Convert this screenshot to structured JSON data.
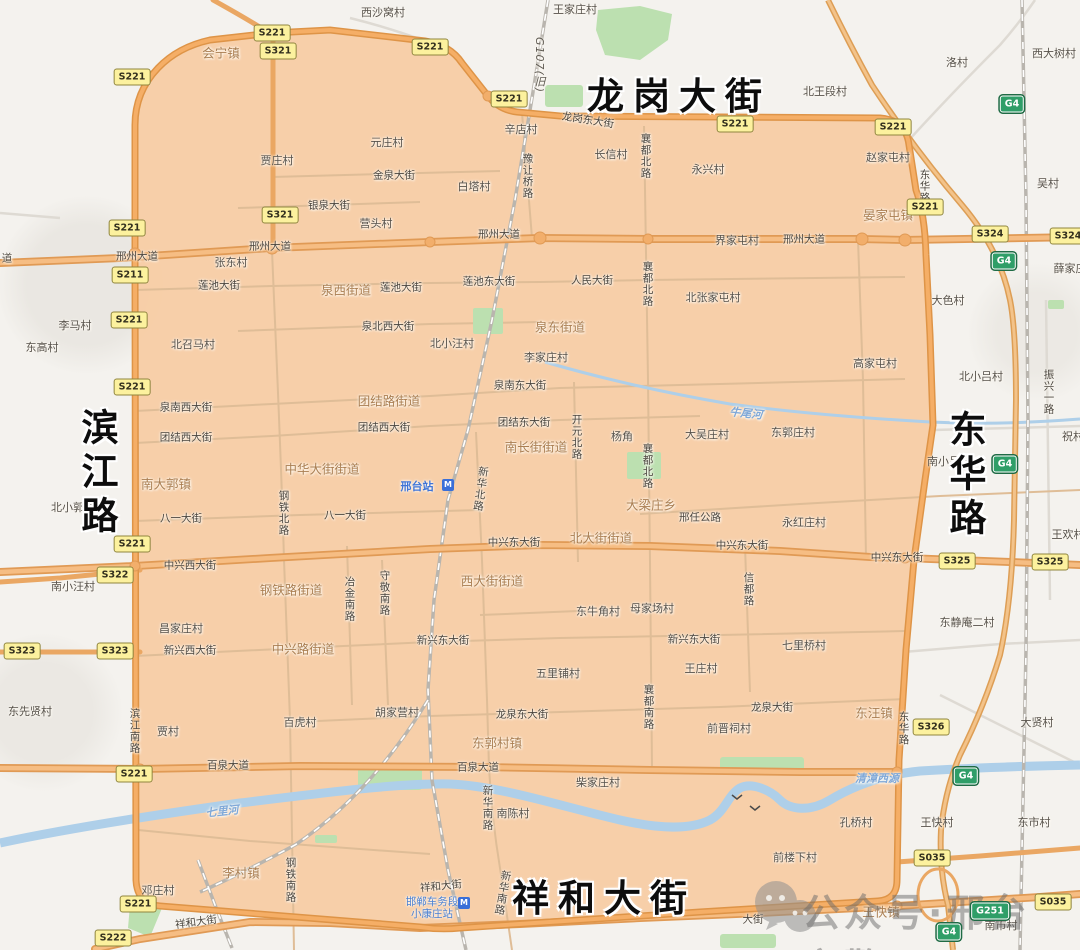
{
  "map": {
    "colors": {
      "region_fill": "#f7cda6",
      "region_ring_casing": "#de9447",
      "region_ring_fill": "#f5ae66",
      "major_road_casing": "#e09a55",
      "major_road_fill": "#f6bd83",
      "minor_road_inside": "#dfbd97",
      "minor_road_outside": "#dedad3",
      "river": "#aecfe9",
      "green_area": "#bce0b0",
      "railway": "#b9b5ae",
      "shield_yellow": "#fcf19e",
      "shield_green": "#2f9e68"
    },
    "big_labels": [
      {
        "text": "龙岗大街",
        "x": 679,
        "y": 93
      },
      {
        "text": "滨江路",
        "x": 96,
        "y": 474,
        "vertical": true
      },
      {
        "text": "东华路",
        "x": 964,
        "y": 476,
        "vertical": true
      },
      {
        "text": "祥和大街",
        "x": 604,
        "y": 895
      }
    ],
    "district_labels": [
      {
        "text": "会宁镇",
        "x": 221,
        "y": 52
      },
      {
        "text": "晏家屯镇",
        "x": 888,
        "y": 214
      },
      {
        "text": "泉西街道",
        "x": 346,
        "y": 289
      },
      {
        "text": "泉东街道",
        "x": 560,
        "y": 326
      },
      {
        "text": "团结路街道",
        "x": 389,
        "y": 400
      },
      {
        "text": "南长街街道",
        "x": 536,
        "y": 446
      },
      {
        "text": "中华大街街道",
        "x": 322,
        "y": 468
      },
      {
        "text": "南大郭镇",
        "x": 166,
        "y": 483
      },
      {
        "text": "大梁庄乡",
        "x": 651,
        "y": 504
      },
      {
        "text": "北大街街道",
        "x": 601,
        "y": 537
      },
      {
        "text": "钢铁路街道",
        "x": 291,
        "y": 589
      },
      {
        "text": "西大街街道",
        "x": 492,
        "y": 580
      },
      {
        "text": "中兴路街道",
        "x": 303,
        "y": 648
      },
      {
        "text": "东郭村镇",
        "x": 497,
        "y": 742
      },
      {
        "text": "李村镇",
        "x": 241,
        "y": 872
      },
      {
        "text": "东汪镇",
        "x": 874,
        "y": 712
      },
      {
        "text": "王快镇",
        "x": 881,
        "y": 911
      }
    ],
    "village_labels": [
      {
        "text": "西沙窝村",
        "x": 383,
        "y": 12
      },
      {
        "text": "王家庄村",
        "x": 575,
        "y": 9
      },
      {
        "text": "北王段村",
        "x": 825,
        "y": 91
      },
      {
        "text": "洛村",
        "x": 957,
        "y": 62
      },
      {
        "text": "西大树村",
        "x": 1054,
        "y": 53
      },
      {
        "text": "吴村",
        "x": 1048,
        "y": 183
      },
      {
        "text": "贾庄村",
        "x": 277,
        "y": 160
      },
      {
        "text": "元庄村",
        "x": 387,
        "y": 142
      },
      {
        "text": "辛店村",
        "x": 521,
        "y": 129
      },
      {
        "text": "白塔村",
        "x": 474,
        "y": 186
      },
      {
        "text": "长信村",
        "x": 611,
        "y": 154
      },
      {
        "text": "永兴村",
        "x": 708,
        "y": 169
      },
      {
        "text": "赵家屯村",
        "x": 888,
        "y": 157
      },
      {
        "text": "营头村",
        "x": 376,
        "y": 223
      },
      {
        "text": "张东村",
        "x": 231,
        "y": 262
      },
      {
        "text": "界家屯村",
        "x": 737,
        "y": 240
      },
      {
        "text": "北张家屯村",
        "x": 713,
        "y": 297
      },
      {
        "text": "薛家庄",
        "x": 1070,
        "y": 268
      },
      {
        "text": "李马村",
        "x": 75,
        "y": 325
      },
      {
        "text": "东高村",
        "x": 42,
        "y": 347
      },
      {
        "text": "北召马村",
        "x": 193,
        "y": 344
      },
      {
        "text": "北小汪村",
        "x": 452,
        "y": 343
      },
      {
        "text": "李家庄村",
        "x": 546,
        "y": 357
      },
      {
        "text": "大色村",
        "x": 948,
        "y": 300
      },
      {
        "text": "高家屯村",
        "x": 875,
        "y": 363
      },
      {
        "text": "北小吕村",
        "x": 981,
        "y": 376
      },
      {
        "text": "杨角",
        "x": 622,
        "y": 436
      },
      {
        "text": "大吴庄村",
        "x": 707,
        "y": 434
      },
      {
        "text": "东郭庄村",
        "x": 793,
        "y": 432
      },
      {
        "text": "南小吕村",
        "x": 949,
        "y": 461
      },
      {
        "text": "祝村",
        "x": 1073,
        "y": 436
      },
      {
        "text": "北小郭村",
        "x": 73,
        "y": 507
      },
      {
        "text": "永红庄村",
        "x": 804,
        "y": 522
      },
      {
        "text": "王欢村",
        "x": 1068,
        "y": 534
      },
      {
        "text": "东静庵二村",
        "x": 967,
        "y": 622
      },
      {
        "text": "南小汪村",
        "x": 73,
        "y": 586
      },
      {
        "text": "昌家庄村",
        "x": 181,
        "y": 628
      },
      {
        "text": "东牛角村",
        "x": 598,
        "y": 611
      },
      {
        "text": "母家场村",
        "x": 652,
        "y": 608
      },
      {
        "text": "五里铺村",
        "x": 558,
        "y": 673
      },
      {
        "text": "王庄村",
        "x": 701,
        "y": 668
      },
      {
        "text": "七里桥村",
        "x": 804,
        "y": 645
      },
      {
        "text": "东先贤村",
        "x": 30,
        "y": 711
      },
      {
        "text": "贾村",
        "x": 168,
        "y": 731
      },
      {
        "text": "百虎村",
        "x": 300,
        "y": 722
      },
      {
        "text": "胡家营村",
        "x": 397,
        "y": 712
      },
      {
        "text": "前晋祠村",
        "x": 729,
        "y": 728
      },
      {
        "text": "大贤村",
        "x": 1037,
        "y": 722
      },
      {
        "text": "邓庄村",
        "x": 158,
        "y": 890
      },
      {
        "text": "柴家庄村",
        "x": 598,
        "y": 782
      },
      {
        "text": "南陈村",
        "x": 513,
        "y": 813
      },
      {
        "text": "孔桥村",
        "x": 856,
        "y": 822
      },
      {
        "text": "王快村",
        "x": 937,
        "y": 822
      },
      {
        "text": "东市村",
        "x": 1034,
        "y": 822
      },
      {
        "text": "前楼下村",
        "x": 795,
        "y": 857
      },
      {
        "text": "南市村",
        "x": 1001,
        "y": 925
      }
    ],
    "road_labels": [
      {
        "text": "邢州大道",
        "x": 137,
        "y": 256
      },
      {
        "text": "邢州大道",
        "x": 270,
        "y": 246
      },
      {
        "text": "邢州大道",
        "x": 499,
        "y": 234
      },
      {
        "text": "邢州大道",
        "x": 804,
        "y": 239
      },
      {
        "text": "道",
        "x": 7,
        "y": 258
      },
      {
        "text": "龙岗东大街",
        "x": 588,
        "y": 120,
        "rot": 9
      },
      {
        "text": "金泉大街",
        "x": 394,
        "y": 175
      },
      {
        "text": "银泉大街",
        "x": 329,
        "y": 205
      },
      {
        "text": "莲池大街",
        "x": 219,
        "y": 285
      },
      {
        "text": "莲池大街",
        "x": 401,
        "y": 287
      },
      {
        "text": "莲池东大街",
        "x": 489,
        "y": 281
      },
      {
        "text": "人民大街",
        "x": 592,
        "y": 280
      },
      {
        "text": "泉北西大街",
        "x": 388,
        "y": 326
      },
      {
        "text": "泉南西大街",
        "x": 186,
        "y": 407
      },
      {
        "text": "泉南东大街",
        "x": 520,
        "y": 385
      },
      {
        "text": "团结西大街",
        "x": 186,
        "y": 437
      },
      {
        "text": "团结西大街",
        "x": 384,
        "y": 427
      },
      {
        "text": "团结东大街",
        "x": 524,
        "y": 422
      },
      {
        "text": "八一大街",
        "x": 181,
        "y": 518
      },
      {
        "text": "八一大街",
        "x": 345,
        "y": 515
      },
      {
        "text": "邢任公路",
        "x": 700,
        "y": 517
      },
      {
        "text": "中兴西大街",
        "x": 190,
        "y": 565
      },
      {
        "text": "中兴东大街",
        "x": 514,
        "y": 542
      },
      {
        "text": "中兴东大街",
        "x": 742,
        "y": 545
      },
      {
        "text": "中兴东大街",
        "x": 897,
        "y": 557
      },
      {
        "text": "新兴西大街",
        "x": 190,
        "y": 650
      },
      {
        "text": "新兴东大街",
        "x": 443,
        "y": 640
      },
      {
        "text": "新兴东大街",
        "x": 694,
        "y": 639
      },
      {
        "text": "龙泉东大街",
        "x": 522,
        "y": 714
      },
      {
        "text": "龙泉大街",
        "x": 772,
        "y": 707
      },
      {
        "text": "百泉大道",
        "x": 228,
        "y": 765
      },
      {
        "text": "百泉大道",
        "x": 478,
        "y": 767
      },
      {
        "text": "祥和大街",
        "x": 196,
        "y": 922,
        "rot": -8
      },
      {
        "text": "祥和大街",
        "x": 441,
        "y": 886,
        "rot": -6
      },
      {
        "text": "大街",
        "x": 753,
        "y": 919
      },
      {
        "text": "襄都北路",
        "x": 646,
        "y": 156,
        "vertical": true
      },
      {
        "text": "襄都北路",
        "x": 648,
        "y": 284,
        "vertical": true
      },
      {
        "text": "襄都北路",
        "x": 648,
        "y": 466,
        "vertical": true
      },
      {
        "text": "襄都南路",
        "x": 649,
        "y": 707,
        "vertical": true
      },
      {
        "text": "豫让桥路",
        "x": 528,
        "y": 176,
        "vertical": true
      },
      {
        "text": "开元北路",
        "x": 577,
        "y": 437,
        "vertical": true
      },
      {
        "text": "新华北路",
        "x": 481,
        "y": 489,
        "vertical": true,
        "rot": 8
      },
      {
        "text": "新华南路",
        "x": 488,
        "y": 808,
        "vertical": true
      },
      {
        "text": "新华南路",
        "x": 503,
        "y": 893,
        "vertical": true,
        "rot": 10
      },
      {
        "text": "钢铁北路",
        "x": 284,
        "y": 513,
        "vertical": true
      },
      {
        "text": "钢铁南路",
        "x": 291,
        "y": 880,
        "vertical": true
      },
      {
        "text": "冶金南路",
        "x": 350,
        "y": 599,
        "vertical": true
      },
      {
        "text": "守敬南路",
        "x": 385,
        "y": 593,
        "vertical": true
      },
      {
        "text": "信都路",
        "x": 749,
        "y": 589,
        "vertical": true
      },
      {
        "text": "东华路",
        "x": 925,
        "y": 186,
        "vertical": true
      },
      {
        "text": "东华路",
        "x": 904,
        "y": 728,
        "vertical": true
      },
      {
        "text": "振兴一路",
        "x": 1049,
        "y": 392,
        "vertical": true
      },
      {
        "text": "滨江南路",
        "x": 135,
        "y": 731,
        "vertical": true
      }
    ],
    "water_labels": [
      {
        "text": "七里河",
        "x": 222,
        "y": 811,
        "rot": -6
      },
      {
        "text": "牛尾河",
        "x": 746,
        "y": 413,
        "rot": 6
      },
      {
        "text": "清漳西源",
        "x": 877,
        "y": 778
      }
    ],
    "highway_ref_label": {
      "text": "G107(旧)",
      "x": 539,
      "y": 65
    },
    "shields": [
      {
        "code": "S221",
        "x": 272,
        "y": 33,
        "kind": "p"
      },
      {
        "code": "S321",
        "x": 278,
        "y": 51,
        "kind": "p"
      },
      {
        "code": "S221",
        "x": 132,
        "y": 77,
        "kind": "p"
      },
      {
        "code": "S221",
        "x": 430,
        "y": 47,
        "kind": "p"
      },
      {
        "code": "S221",
        "x": 509,
        "y": 99,
        "kind": "p"
      },
      {
        "code": "S221",
        "x": 735,
        "y": 124,
        "kind": "p"
      },
      {
        "code": "S221",
        "x": 893,
        "y": 127,
        "kind": "p"
      },
      {
        "code": "S221",
        "x": 925,
        "y": 207,
        "kind": "p"
      },
      {
        "code": "S321",
        "x": 280,
        "y": 215,
        "kind": "p"
      },
      {
        "code": "S221",
        "x": 127,
        "y": 228,
        "kind": "p"
      },
      {
        "code": "S211",
        "x": 130,
        "y": 275,
        "kind": "p"
      },
      {
        "code": "S221",
        "x": 129,
        "y": 320,
        "kind": "p"
      },
      {
        "code": "S324",
        "x": 990,
        "y": 234,
        "kind": "p"
      },
      {
        "code": "S324",
        "x": 1068,
        "y": 236,
        "kind": "p"
      },
      {
        "code": "S221",
        "x": 132,
        "y": 387,
        "kind": "p"
      },
      {
        "code": "S221",
        "x": 132,
        "y": 544,
        "kind": "p"
      },
      {
        "code": "S322",
        "x": 115,
        "y": 575,
        "kind": "p"
      },
      {
        "code": "S323",
        "x": 22,
        "y": 651,
        "kind": "p"
      },
      {
        "code": "S323",
        "x": 115,
        "y": 651,
        "kind": "p"
      },
      {
        "code": "S325",
        "x": 957,
        "y": 561,
        "kind": "p"
      },
      {
        "code": "S325",
        "x": 1050,
        "y": 562,
        "kind": "p"
      },
      {
        "code": "S326",
        "x": 931,
        "y": 727,
        "kind": "p"
      },
      {
        "code": "S221",
        "x": 134,
        "y": 774,
        "kind": "p"
      },
      {
        "code": "S035",
        "x": 932,
        "y": 858,
        "kind": "p"
      },
      {
        "code": "S035",
        "x": 1053,
        "y": 902,
        "kind": "p"
      },
      {
        "code": "S221",
        "x": 138,
        "y": 904,
        "kind": "p"
      },
      {
        "code": "S222",
        "x": 113,
        "y": 938,
        "kind": "p"
      },
      {
        "code": "G4",
        "x": 1012,
        "y": 104,
        "kind": "g"
      },
      {
        "code": "G4",
        "x": 1004,
        "y": 261,
        "kind": "g"
      },
      {
        "code": "G4",
        "x": 1005,
        "y": 464,
        "kind": "g"
      },
      {
        "code": "G4",
        "x": 966,
        "y": 776,
        "kind": "g"
      },
      {
        "code": "G4",
        "x": 949,
        "y": 932,
        "kind": "g"
      },
      {
        "code": "G251",
        "x": 990,
        "y": 911,
        "kind": "g"
      }
    ],
    "transit": {
      "station_name": "邢台站",
      "station_x": 417,
      "station_y": 486,
      "depot_line1": "邯郸车务段",
      "depot_line2": "小康庄站",
      "depot_x": 432,
      "depot_y": 908
    },
    "watermark": {
      "text": "公众号·邢台交警"
    }
  }
}
